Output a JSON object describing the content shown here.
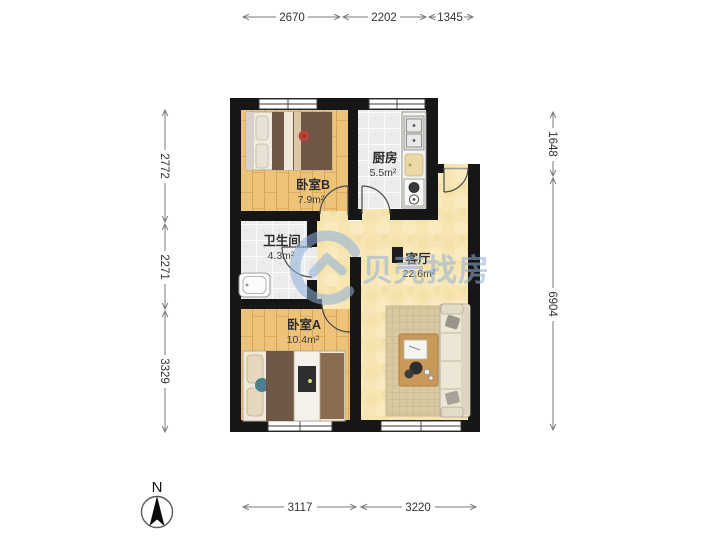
{
  "plan": {
    "type": "apartment-floorplan",
    "rooms": {
      "bedroom_b": {
        "name": "卧室B",
        "area": "7.9m²"
      },
      "kitchen": {
        "name": "厨房",
        "area": "5.5m²"
      },
      "bathroom": {
        "name": "卫生间",
        "area": "4.3m²"
      },
      "living_room span": "",
      "living_room": {
        "name": "客厅",
        "area": "22.6m²"
      },
      "bedroom_a": {
        "name": "卧室A",
        "area": "10.4m²"
      }
    }
  },
  "dimensions": {
    "unit": "mm",
    "top": [
      "2670",
      "2202",
      "1345"
    ],
    "left": [
      "2772",
      "2271",
      "3329"
    ],
    "right": [
      "1648",
      "6904"
    ],
    "bottom": [
      "3117",
      "3220"
    ]
  },
  "watermark": {
    "text": "贝壳找房",
    "color": "#8fb0da"
  },
  "compass": {
    "north_label": "N"
  },
  "colors": {
    "wall": "#161616",
    "wood_floor": "#edc279",
    "tile_floor": "#ececea",
    "living_floor": "#f7e6b4",
    "watermark_blue": "#8fb0da"
  }
}
